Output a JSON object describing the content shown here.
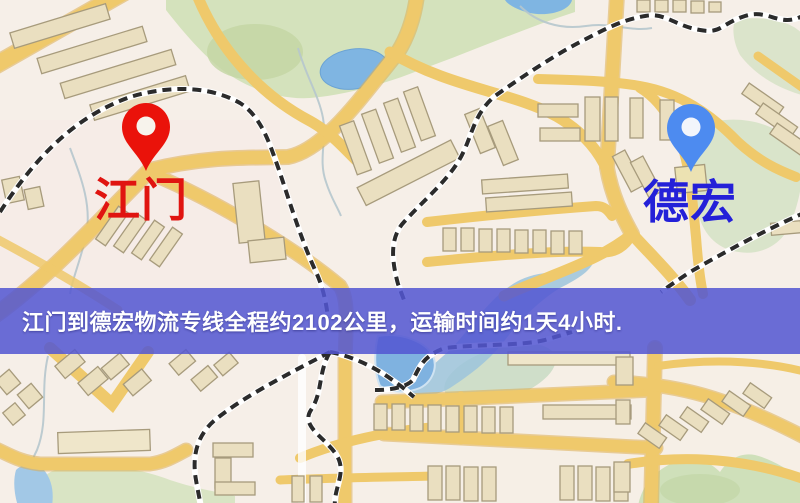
{
  "banner": {
    "text": "江门到德宏物流专线全程约2102公里，运输时间约1天4小时.",
    "background_color": "#5356d2",
    "text_color": "#ffffff"
  },
  "route": {
    "origin": "江门",
    "destination": "德宏",
    "distance": "约2102公里",
    "duration": "约1天4小时"
  },
  "map": {
    "origin": {
      "label": "江门",
      "label_color": "#e01410",
      "pin_icon": "red-map-pin-icon",
      "pin_color": "#ea120a",
      "pin_hole_color": "#f7f3ec"
    },
    "destination": {
      "label": "德宏",
      "label_color": "#2420d8",
      "pin_icon": "blue-map-pin-icon",
      "pin_color": "#4d8bf0",
      "pin_hole_color": "#f2f5fb"
    },
    "colors": {
      "background": "#f6efe8",
      "road": "#efc96b",
      "road_casing": "#ddae52",
      "park": "#d4e2bc",
      "water": "#7fb2e0",
      "building_fill": "#eadfc0",
      "building_stroke": "#a79b7c",
      "railway": "#2b2b2b"
    }
  }
}
